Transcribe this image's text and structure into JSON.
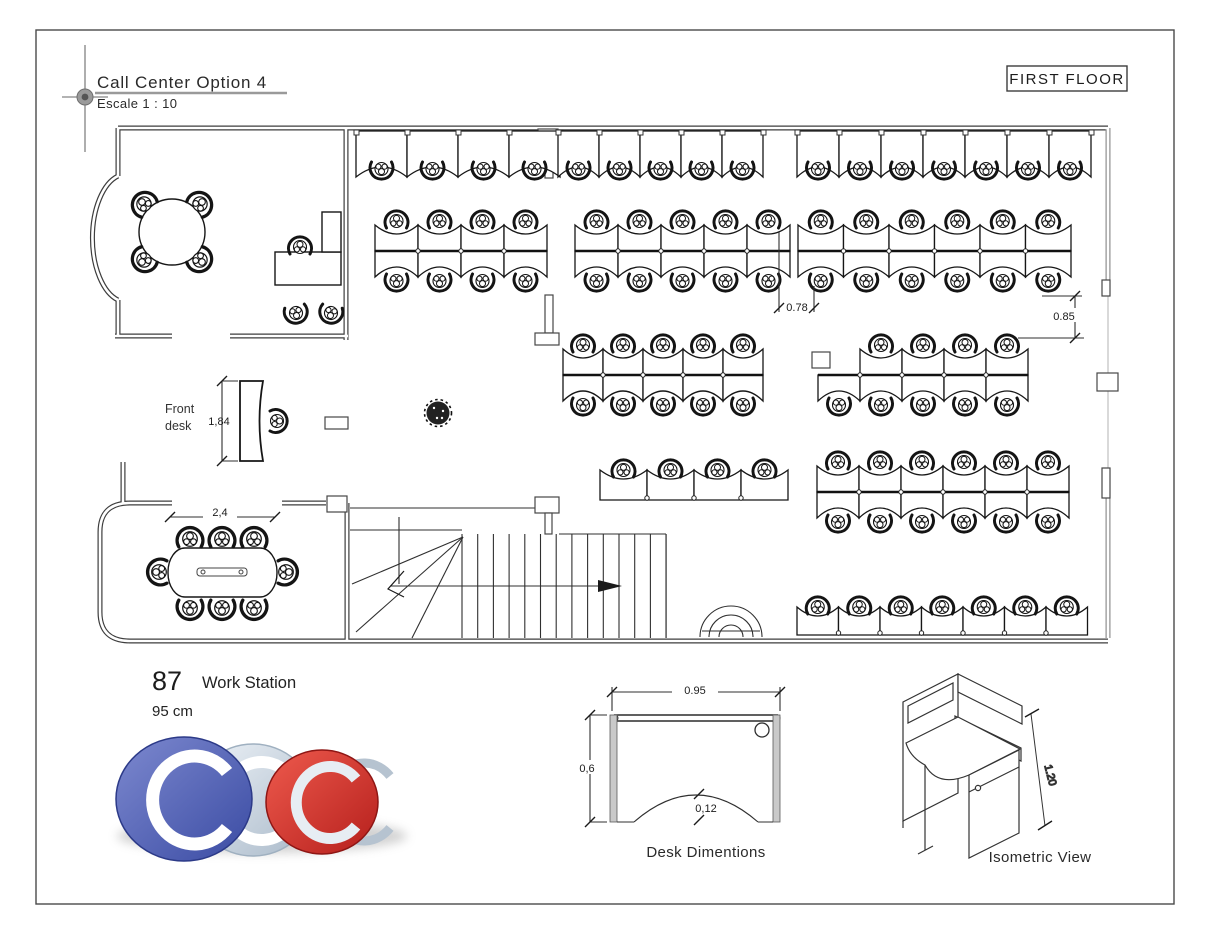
{
  "sheet": {
    "title": "Call Center Option 4",
    "scale": "Escale 1 : 10",
    "floor_tag": "FIRST FLOOR"
  },
  "plan": {
    "front_desk_label_line1": "Front",
    "front_desk_label_line2": "desk",
    "dim_front_desk": "1,84",
    "dim_meeting_table": "2,4",
    "dim_aisle": "0.78",
    "dim_gap": "0.85"
  },
  "summary": {
    "workstation_count": "87",
    "workstation_label": "Work Station",
    "workstation_size": "95 cm"
  },
  "desk_diagram": {
    "caption": "Desk Dimentions",
    "dim_width": "0.95",
    "dim_depth": "0,6",
    "dim_notch": "0,12"
  },
  "isometric": {
    "caption": "Isometric View",
    "dim_height": "1.20"
  },
  "logo": {
    "letters": [
      "C",
      "C",
      "C"
    ],
    "colors": {
      "blue": "#5361b2",
      "silver": "#ccd8e3",
      "red": "#d93831"
    }
  }
}
